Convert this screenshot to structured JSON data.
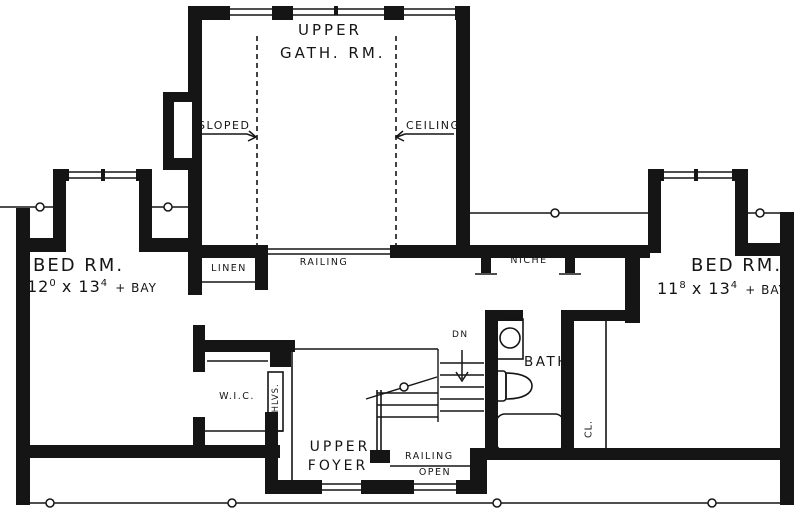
{
  "plan": {
    "colors": {
      "ink": "#151515",
      "background": "#ffffff"
    },
    "rooms": {
      "gathering": {
        "line1": "UPPER",
        "line2": "GATH. RM."
      },
      "bed_left": {
        "name": "BED RM.",
        "dim1": "12",
        "dim1_sup": "0",
        "times": "x",
        "dim2": "13",
        "dim2_sup": "4",
        "suffix": "+ BAY"
      },
      "bed_right": {
        "name": "BED RM.",
        "dim1": "11",
        "dim1_sup": "8",
        "times": "x",
        "dim2": "13",
        "dim2_sup": "4",
        "suffix": "+ BAY"
      },
      "foyer": {
        "line1": "UPPER",
        "line2": "FOYER"
      },
      "bath": {
        "label": "BATH"
      },
      "wic": {
        "label": "W.I.C."
      }
    },
    "labels": {
      "sloped": "SLOPED",
      "ceiling": "CEILING",
      "railing_gathering": "RAILING",
      "railing_stairs": "RAILING",
      "linen": "LINEN",
      "niche": "NICHE",
      "open_below": "OPEN",
      "down": "DN",
      "shelves": "SHLVS.",
      "closet": "CL."
    }
  }
}
